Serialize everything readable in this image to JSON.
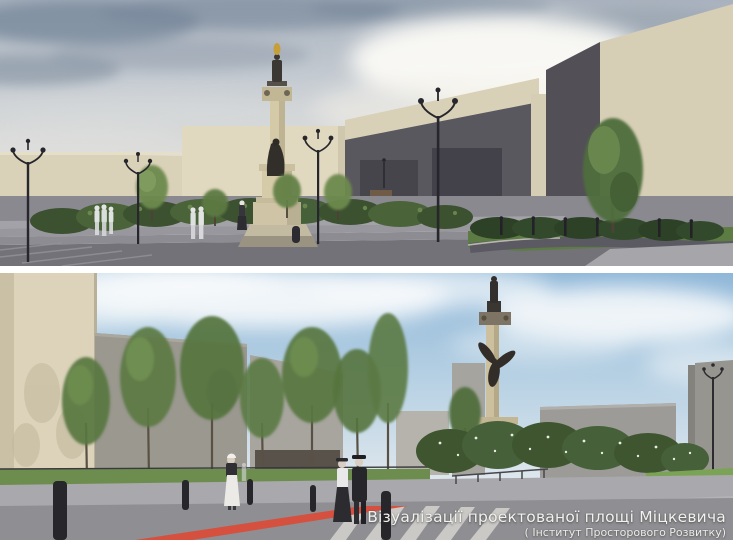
{
  "caption": {
    "title": "Візуалізації проектованої площі Міцкевича",
    "credit": "( Інститут Просторового Розвитку)"
  },
  "palette": {
    "divider_white": "#ffffff",
    "crosswalk_red": "#d5503e",
    "facade_beige": "#d9d1b8",
    "facade_dark_gray": "#5a585f",
    "facade_light_gray": "#9a988f",
    "foliage_green": "#5d7a43",
    "lawn_green": "#7ba356",
    "monument_stone": "#d3c8a6",
    "statue_bronze": "#332f2b",
    "sky_blue": "#8fb7d8",
    "caption_text": "#f2f2ef"
  }
}
